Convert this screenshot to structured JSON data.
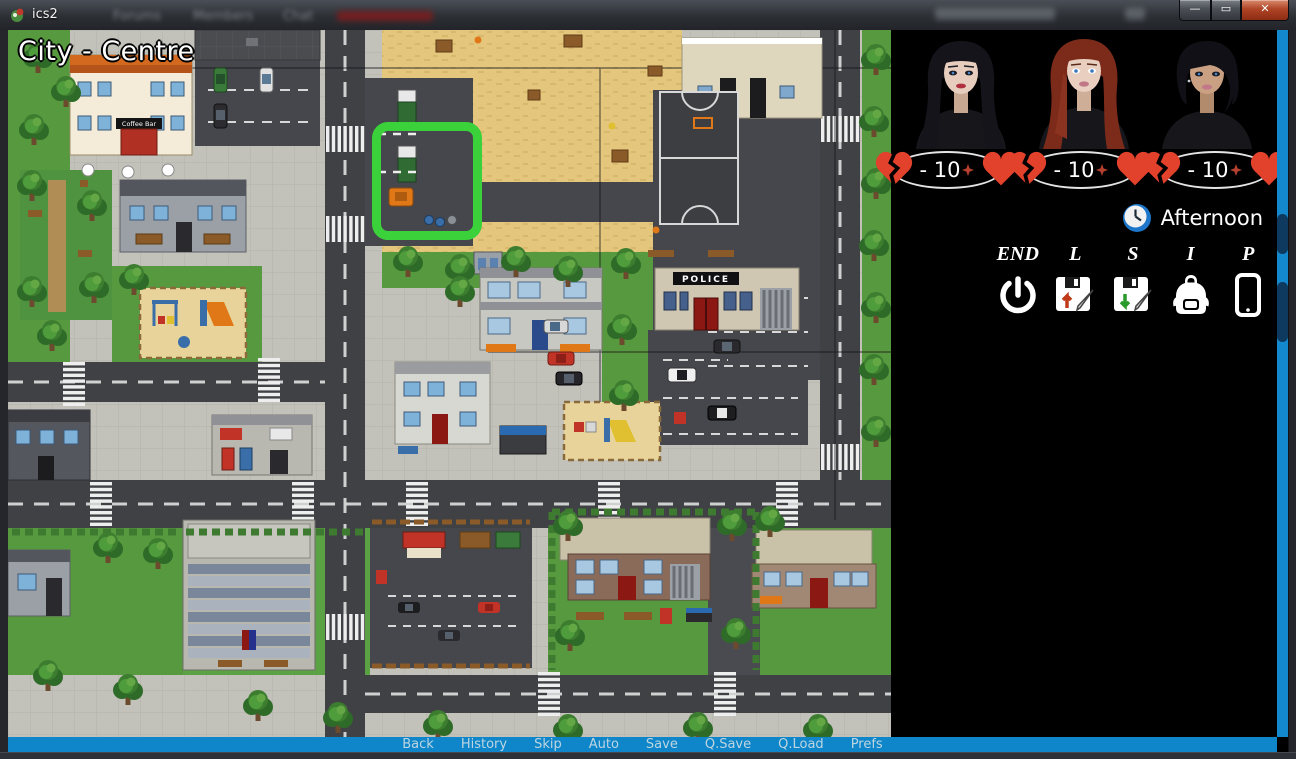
{
  "titlebar": {
    "title": "ics2",
    "background_tabs": {
      "tab1": "Forums",
      "tab2": "Members",
      "tab3": "Chat"
    }
  },
  "map": {
    "location_label": "City - Centre",
    "signs": {
      "coffee_bar": "Coffee Bar",
      "police": "POLICE"
    }
  },
  "panel": {
    "meters": {
      "m1": "- 10",
      "m2": "- 10",
      "m3": "- 10"
    },
    "time_of_day": "Afternoon",
    "buttons": {
      "end": "END",
      "load": "L",
      "save": "S",
      "inventory": "I",
      "phone": "P"
    }
  },
  "quick_menu": {
    "back": "Back",
    "history": "History",
    "skip": "Skip",
    "auto": "Auto",
    "save": "Save",
    "qsave": "Q.Save",
    "qload": "Q.Load",
    "prefs": "Prefs"
  },
  "colors": {
    "accent_blue": "#1488cc",
    "highlight_green": "#3bd13b",
    "heart_red": "#e2412c"
  }
}
